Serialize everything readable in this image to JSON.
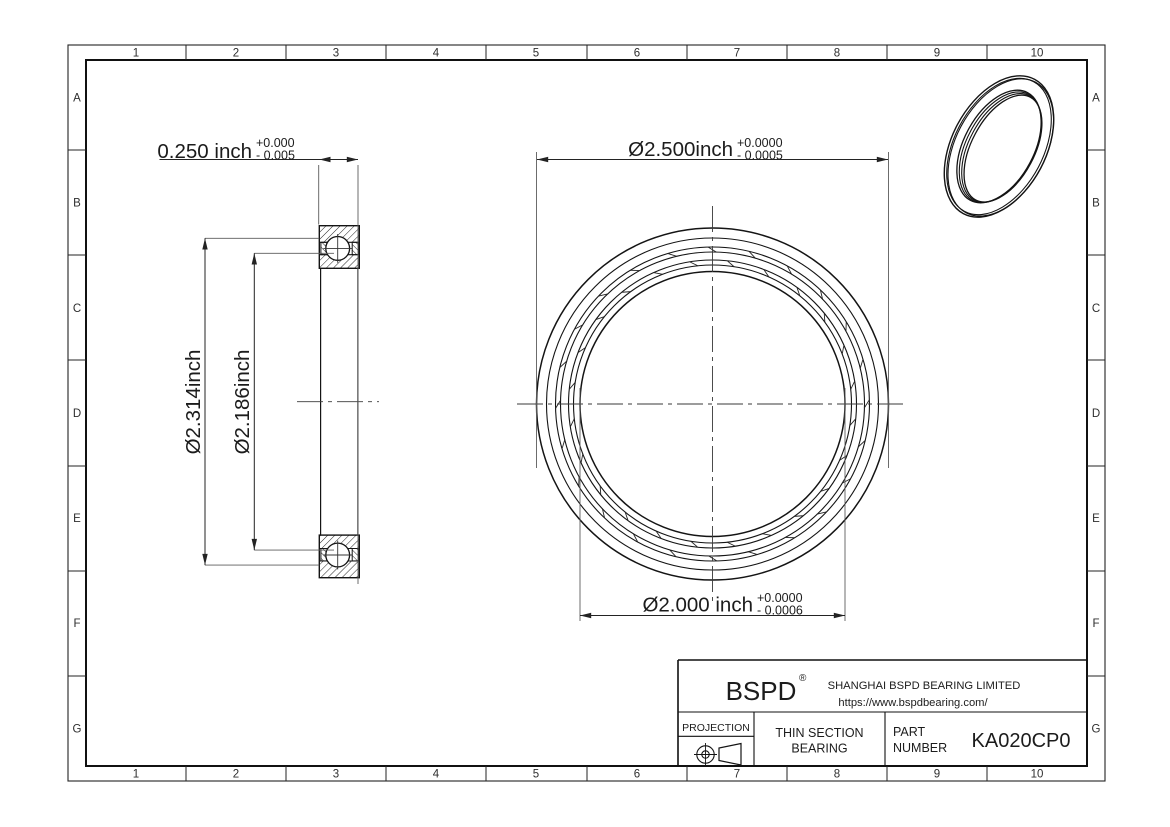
{
  "sheet": {
    "border": {
      "columns": [
        "1",
        "2",
        "3",
        "4",
        "5",
        "6",
        "7",
        "8",
        "9",
        "10"
      ],
      "rows": [
        "A",
        "B",
        "C",
        "D",
        "E",
        "F",
        "G"
      ]
    },
    "section_view": {
      "width_dim": "0.250 inch",
      "width_tol_plus": "+0.000",
      "width_tol_minus": "- 0.005",
      "outer_race_dim": "Ø2.314inch",
      "inner_race_dim": "Ø2.186inch"
    },
    "front_view": {
      "od_dim": "Ø2.500inch",
      "od_tol_plus": "+0.0000",
      "od_tol_minus": "- 0.0005",
      "bore_dim": "Ø2.000 inch",
      "bore_tol_plus": "+0.0000",
      "bore_tol_minus": "- 0.0006"
    },
    "title_block": {
      "logo": "BSPD",
      "registered_mark": "®",
      "company": "SHANGHAI BSPD BEARING LIMITED",
      "website": "https://www.bspdbearing.com/",
      "projection_label": "PROJECTION",
      "product_line1": "THIN SECTION",
      "product_line2": "BEARING",
      "part_label_line1": "PART",
      "part_label_line2": "NUMBER",
      "part_number": "KA020CP0"
    }
  }
}
